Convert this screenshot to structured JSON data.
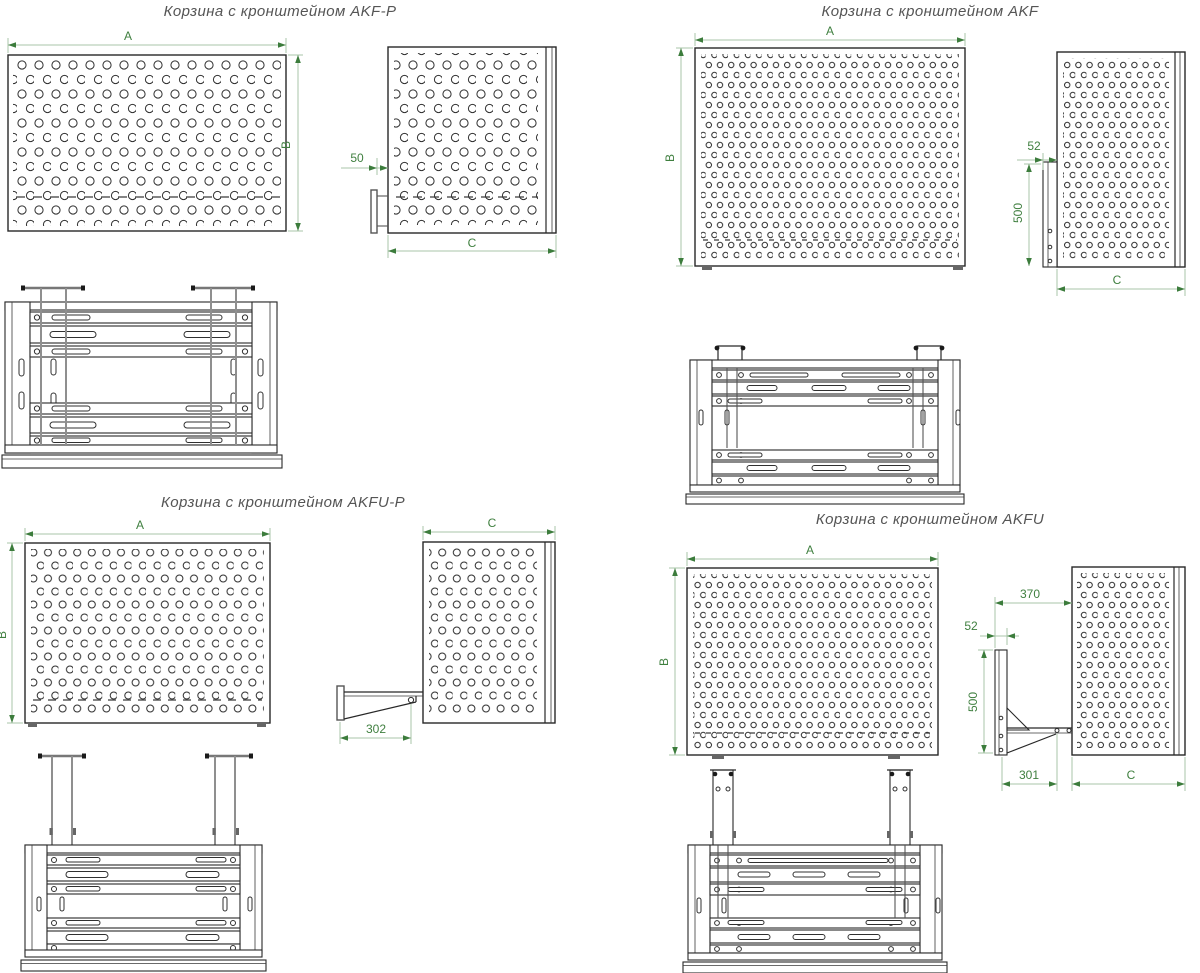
{
  "document": {
    "type": "technical-drawing-sheet",
    "language": "ru"
  },
  "colors": {
    "background": "#ffffff",
    "drawing_line": "#282828",
    "dimension_accent": "#3c7c3c",
    "dimension_line": "#a8c6a8",
    "title_text": "#555555",
    "gray_parts": "#8f8f8f"
  },
  "quadrants": [
    {
      "id": "akf-p",
      "title": "Корзина с кронштейном AKF-P",
      "front": {
        "width_label": "A",
        "height_label": "B"
      },
      "side": {
        "gap_label": "50",
        "depth_label": "C"
      }
    },
    {
      "id": "akf",
      "title": "Корзина с кронштейном AKF",
      "front": {
        "width_label": "A",
        "height_label": "B"
      },
      "side": {
        "gap_label": "52",
        "rail_label": "500",
        "depth_label": "C"
      }
    },
    {
      "id": "akfu-p",
      "title": "Корзина с кронштейном AKFU-P",
      "front": {
        "width_label": "A",
        "height_label": "B"
      },
      "side": {
        "depth_label": "C",
        "arm_label": "302"
      }
    },
    {
      "id": "akfu",
      "title": "Корзина с кронштейном AKFU",
      "front": {
        "width_label": "A",
        "height_label": "B"
      },
      "side": {
        "reach_label": "370",
        "gap_label": "52",
        "rail_label": "500",
        "arm_label": "301",
        "depth_label": "C"
      }
    }
  ]
}
